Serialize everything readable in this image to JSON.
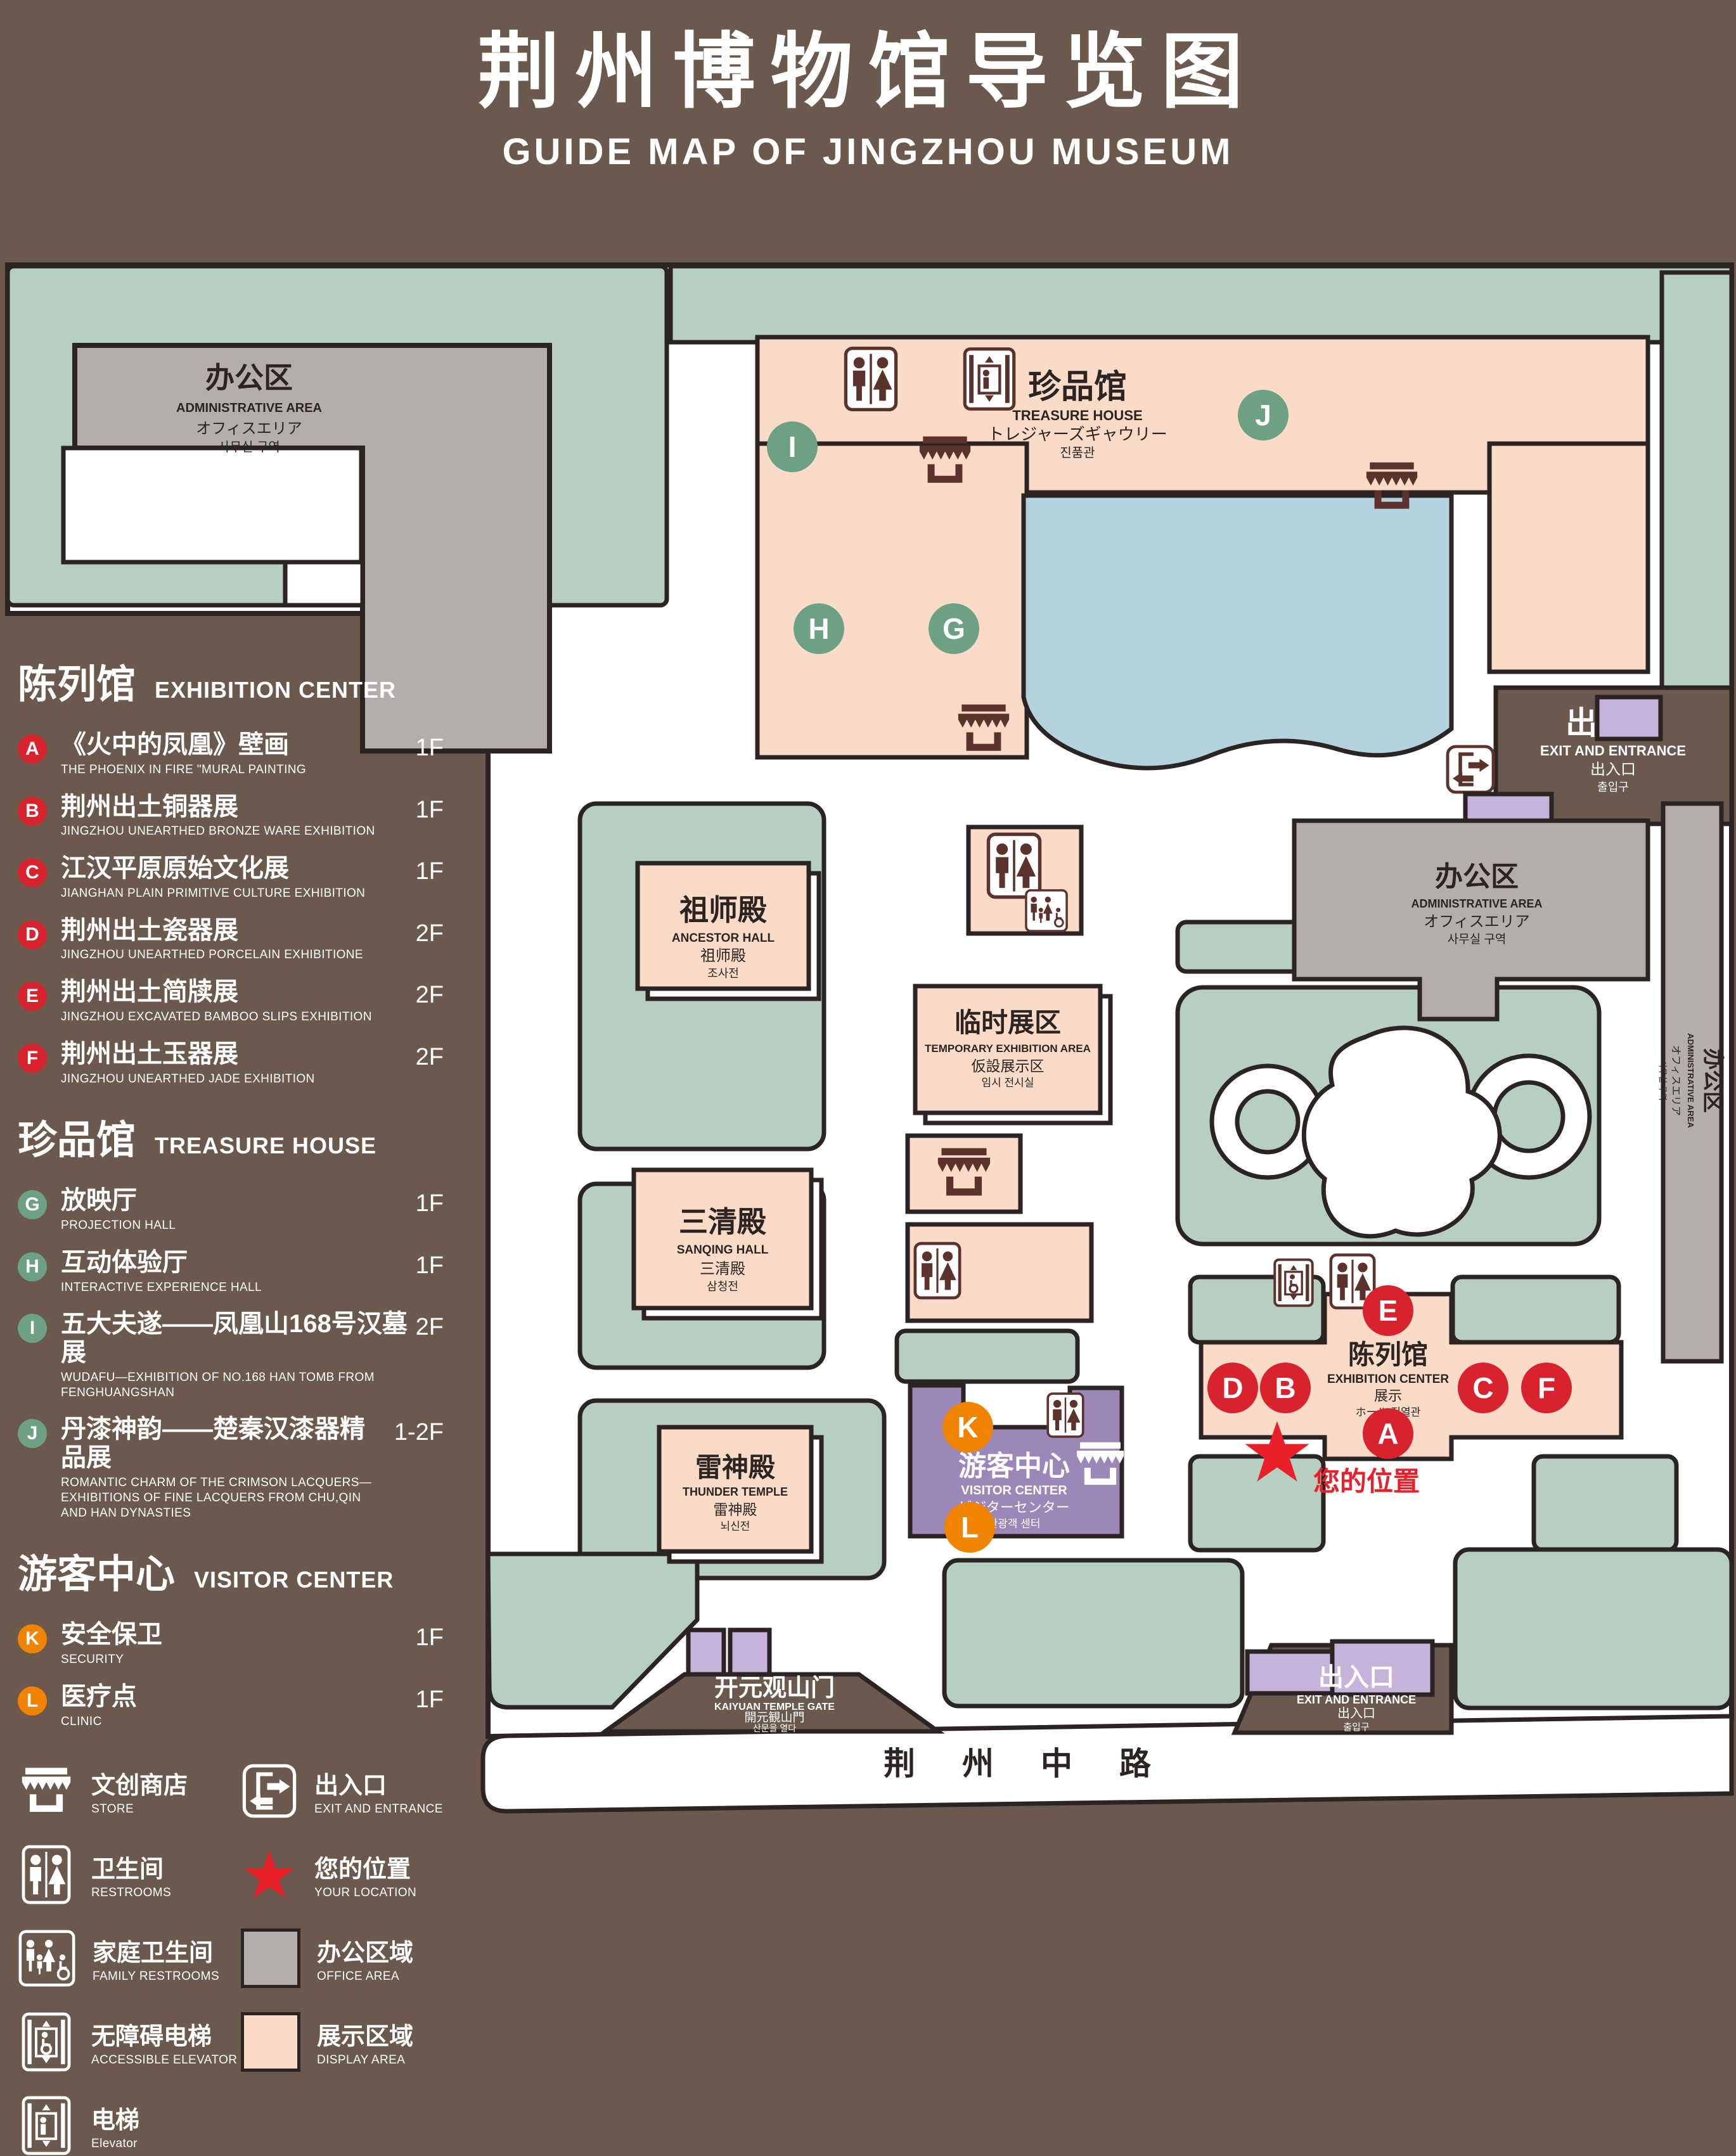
{
  "title": {
    "cn": "荆州博物馆导览图",
    "en": "GUIDE MAP OF JINGZHOU MUSEUM"
  },
  "colors": {
    "background": "#6a594c",
    "outline": "#2b2422",
    "lawn": "#b7cfc1",
    "display_area": "#fadbc8",
    "office_area": "#b3aeab",
    "lake": "#b4d1de",
    "purple_light": "#c7b2d9",
    "visitor_center": "#9d87b9",
    "marker_red": "#d8232f",
    "marker_green": "#6ea183",
    "marker_orange": "#f08300",
    "location_red": "#e8202a",
    "icon_dark": "#5b332c"
  },
  "legend": {
    "sections": [
      {
        "cn": "陈列馆",
        "en": "EXHIBITION CENTER",
        "items": [
          {
            "letter": "A",
            "cn": "《火中的凤凰》壁画",
            "en": "THE PHOENIX IN FIRE \"MURAL PAINTING",
            "floor": "1F"
          },
          {
            "letter": "B",
            "cn": "荆州出土铜器展",
            "en": "JINGZHOU UNEARTHED BRONZE WARE EXHIBITION",
            "floor": "1F"
          },
          {
            "letter": "C",
            "cn": "江汉平原原始文化展",
            "en": "JIANGHAN PLAIN PRIMITIVE CULTURE EXHIBITION",
            "floor": "1F"
          },
          {
            "letter": "D",
            "cn": "荆州出土瓷器展",
            "en": "JINGZHOU UNEARTHED PORCELAIN EXHIBITIONE",
            "floor": "2F"
          },
          {
            "letter": "E",
            "cn": "荆州出土简牍展",
            "en": "JINGZHOU EXCAVATED BAMBOO SLIPS EXHIBITION",
            "floor": "2F"
          },
          {
            "letter": "F",
            "cn": "荆州出土玉器展",
            "en": "JINGZHOU UNEARTHED JADE EXHIBITION",
            "floor": "2F"
          }
        ]
      },
      {
        "cn": "珍品馆",
        "en": "TREASURE HOUSE",
        "items": [
          {
            "letter": "G",
            "cn": "放映厅",
            "en": "PROJECTION HALL",
            "floor": "1F"
          },
          {
            "letter": "H",
            "cn": "互动体验厅",
            "en": "INTERACTIVE EXPERIENCE HALL",
            "floor": "1F"
          },
          {
            "letter": "I",
            "cn": "五大夫遂——凤凰山168号汉墓展",
            "en": "WUDAFU—EXHIBITION OF NO.168 HAN TOMB FROM FENGHUANGSHAN",
            "floor": "2F"
          },
          {
            "letter": "J",
            "cn": "丹漆神韵——楚秦汉漆器精品展",
            "en": "ROMANTIC CHARM OF THE CRIMSON LACQUERS—EXHIBITIONS OF FINE LACQUERS FROM CHU,QIN AND HAN DYNASTIES",
            "floor": "1-2F"
          }
        ]
      },
      {
        "cn": "游客中心",
        "en": "VISITOR CENTER",
        "items": [
          {
            "letter": "K",
            "cn": "安全保卫",
            "en": "SECURITY",
            "floor": "1F"
          },
          {
            "letter": "L",
            "cn": "医疗点",
            "en": "CLINIC",
            "floor": "1F"
          }
        ]
      }
    ],
    "symbols": [
      {
        "icon": "store-icon",
        "cn": "文创商店",
        "en": "STORE"
      },
      {
        "icon": "exit-icon",
        "cn": "出入口",
        "en": "EXIT AND ENTRANCE"
      },
      {
        "icon": "restroom-icon",
        "cn": "卫生间",
        "en": "RESTROOMS"
      },
      {
        "icon": "location-star-icon",
        "cn": "您的位置",
        "en": "YOUR LOCATION"
      },
      {
        "icon": "family-restroom-icon",
        "cn": "家庭卫生间",
        "en": "FAMILY RESTROOMS"
      },
      {
        "icon": "office-area-swatch",
        "cn": "办公区域",
        "en": "OFFICE AREA"
      },
      {
        "icon": "accessible-elevator-icon",
        "cn": "无障碍电梯",
        "en": "ACCESSIBLE ELEVATOR"
      },
      {
        "icon": "display-area-swatch",
        "cn": "展示区域",
        "en": "DISPLAY AREA"
      },
      {
        "icon": "elevator-icon",
        "cn": "电梯",
        "en": "Elevator"
      }
    ]
  },
  "map": {
    "buildings": {
      "admin_nw": {
        "cn": "办公区",
        "en": "ADMINISTRATIVE AREA",
        "jp": "オフィスエリア",
        "kr": "사무실 구역"
      },
      "treasure_house": {
        "cn": "珍品馆",
        "en": "TREASURE HOUSE",
        "jp": "トレジャーズギャウリー",
        "kr": "진품관"
      },
      "ancestor_hall": {
        "cn": "祖师殿",
        "en": "ANCESTOR HALL",
        "jp": "祖师殿",
        "kr": "조사전"
      },
      "sanqing_hall": {
        "cn": "三清殿",
        "en": "SANQING HALL",
        "jp": "三清殿",
        "kr": "삼청전"
      },
      "thunder_temple": {
        "cn": "雷神殿",
        "en": "THUNDER TEMPLE",
        "jp": "雷神殿",
        "kr": "뇌신전"
      },
      "temporary_exhibition": {
        "cn": "临时展区",
        "en": "TEMPORARY EXHIBITION AREA",
        "jp": "仮設展示区",
        "kr": "임시 전시실"
      },
      "admin_e": {
        "cn": "办公区",
        "en": "ADMINISTRATIVE AREA",
        "jp": "オフィスエリア",
        "kr": "사무실 구역"
      },
      "admin_strip": {
        "cn": "办公区",
        "en": "ADMINISTRATIVE AREA",
        "jp": "オフィスエリア",
        "kr": "사무실 구역"
      },
      "exhibition_center": {
        "cn": "陈列馆",
        "en": "EXHIBITION CENTER",
        "jp": "展示",
        "kr": "ホール 진열관"
      },
      "visitor_center": {
        "cn": "游客中心",
        "en": "VISITOR CENTER",
        "jp": "ビジターセンター",
        "kr": "관광객 센터"
      },
      "entrance_ne": {
        "cn": "出入口",
        "en": "EXIT AND ENTRANCE",
        "jp": "出入口",
        "kr": "출입구"
      },
      "exit_s": {
        "cn": "出入口",
        "en": "EXIT AND ENTRANCE",
        "jp": "出入口",
        "kr": "출입구"
      },
      "gate": {
        "cn": "开元观山门",
        "en": "KAIYUAN TEMPLE GATE",
        "jp": "開元観山門",
        "kr": "산문을 열다"
      }
    },
    "road": {
      "label": "荆 州 中 路"
    },
    "your_location": {
      "label": "您的位置"
    },
    "markers": {
      "A": "A",
      "B": "B",
      "C": "C",
      "D": "D",
      "E": "E",
      "F": "F",
      "G": "G",
      "H": "H",
      "I": "I",
      "J": "J",
      "K": "K",
      "L": "L"
    }
  }
}
